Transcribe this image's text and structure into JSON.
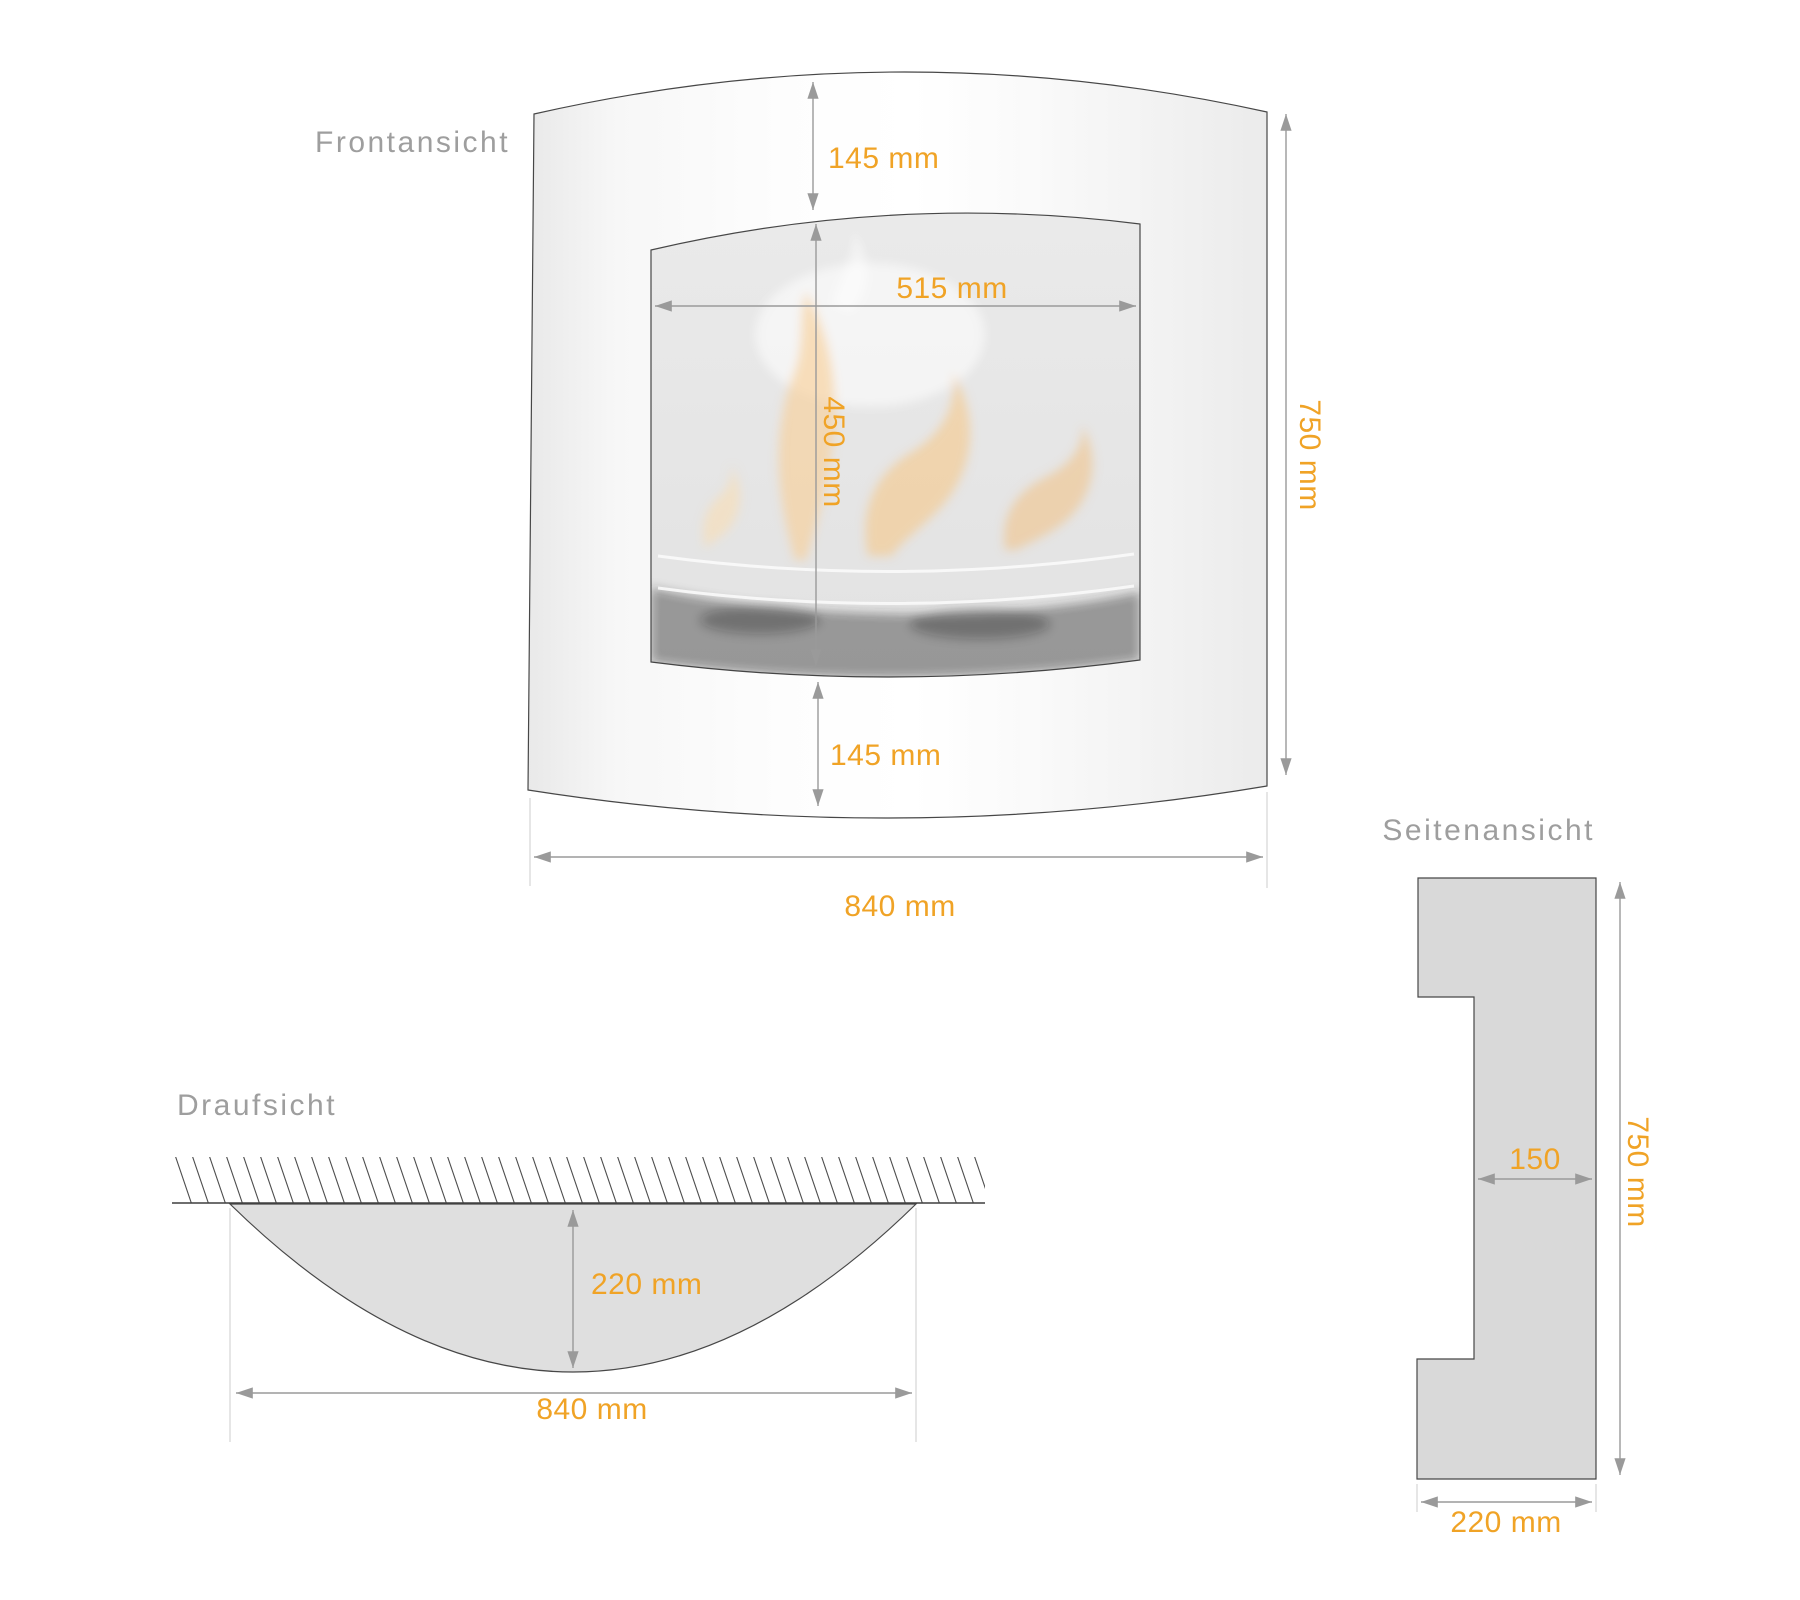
{
  "drawing": {
    "front": {
      "title": "Frontansicht",
      "top_margin": "145 mm",
      "glass_width": "515 mm",
      "glass_height": "450 mm",
      "bottom_margin": "145 mm",
      "total_width": "840 mm",
      "total_height": "750 mm"
    },
    "top": {
      "title": "Draufsicht",
      "depth": "220 mm",
      "width": "840 mm"
    },
    "side": {
      "title": "Seitenansicht",
      "upper_depth": "150",
      "height": "750 mm",
      "base_width": "220 mm"
    }
  },
  "colors": {
    "accent": "#F0A326",
    "dimension_line": "#9A9A9A",
    "outline": "#474747",
    "title_text": "#9E9E9E",
    "body_fill_light": "#FFFFFF",
    "body_fill_shade": "#ECECEC",
    "glass_fill": "#E8E8E8",
    "section_fill": "#D9D9D9"
  }
}
